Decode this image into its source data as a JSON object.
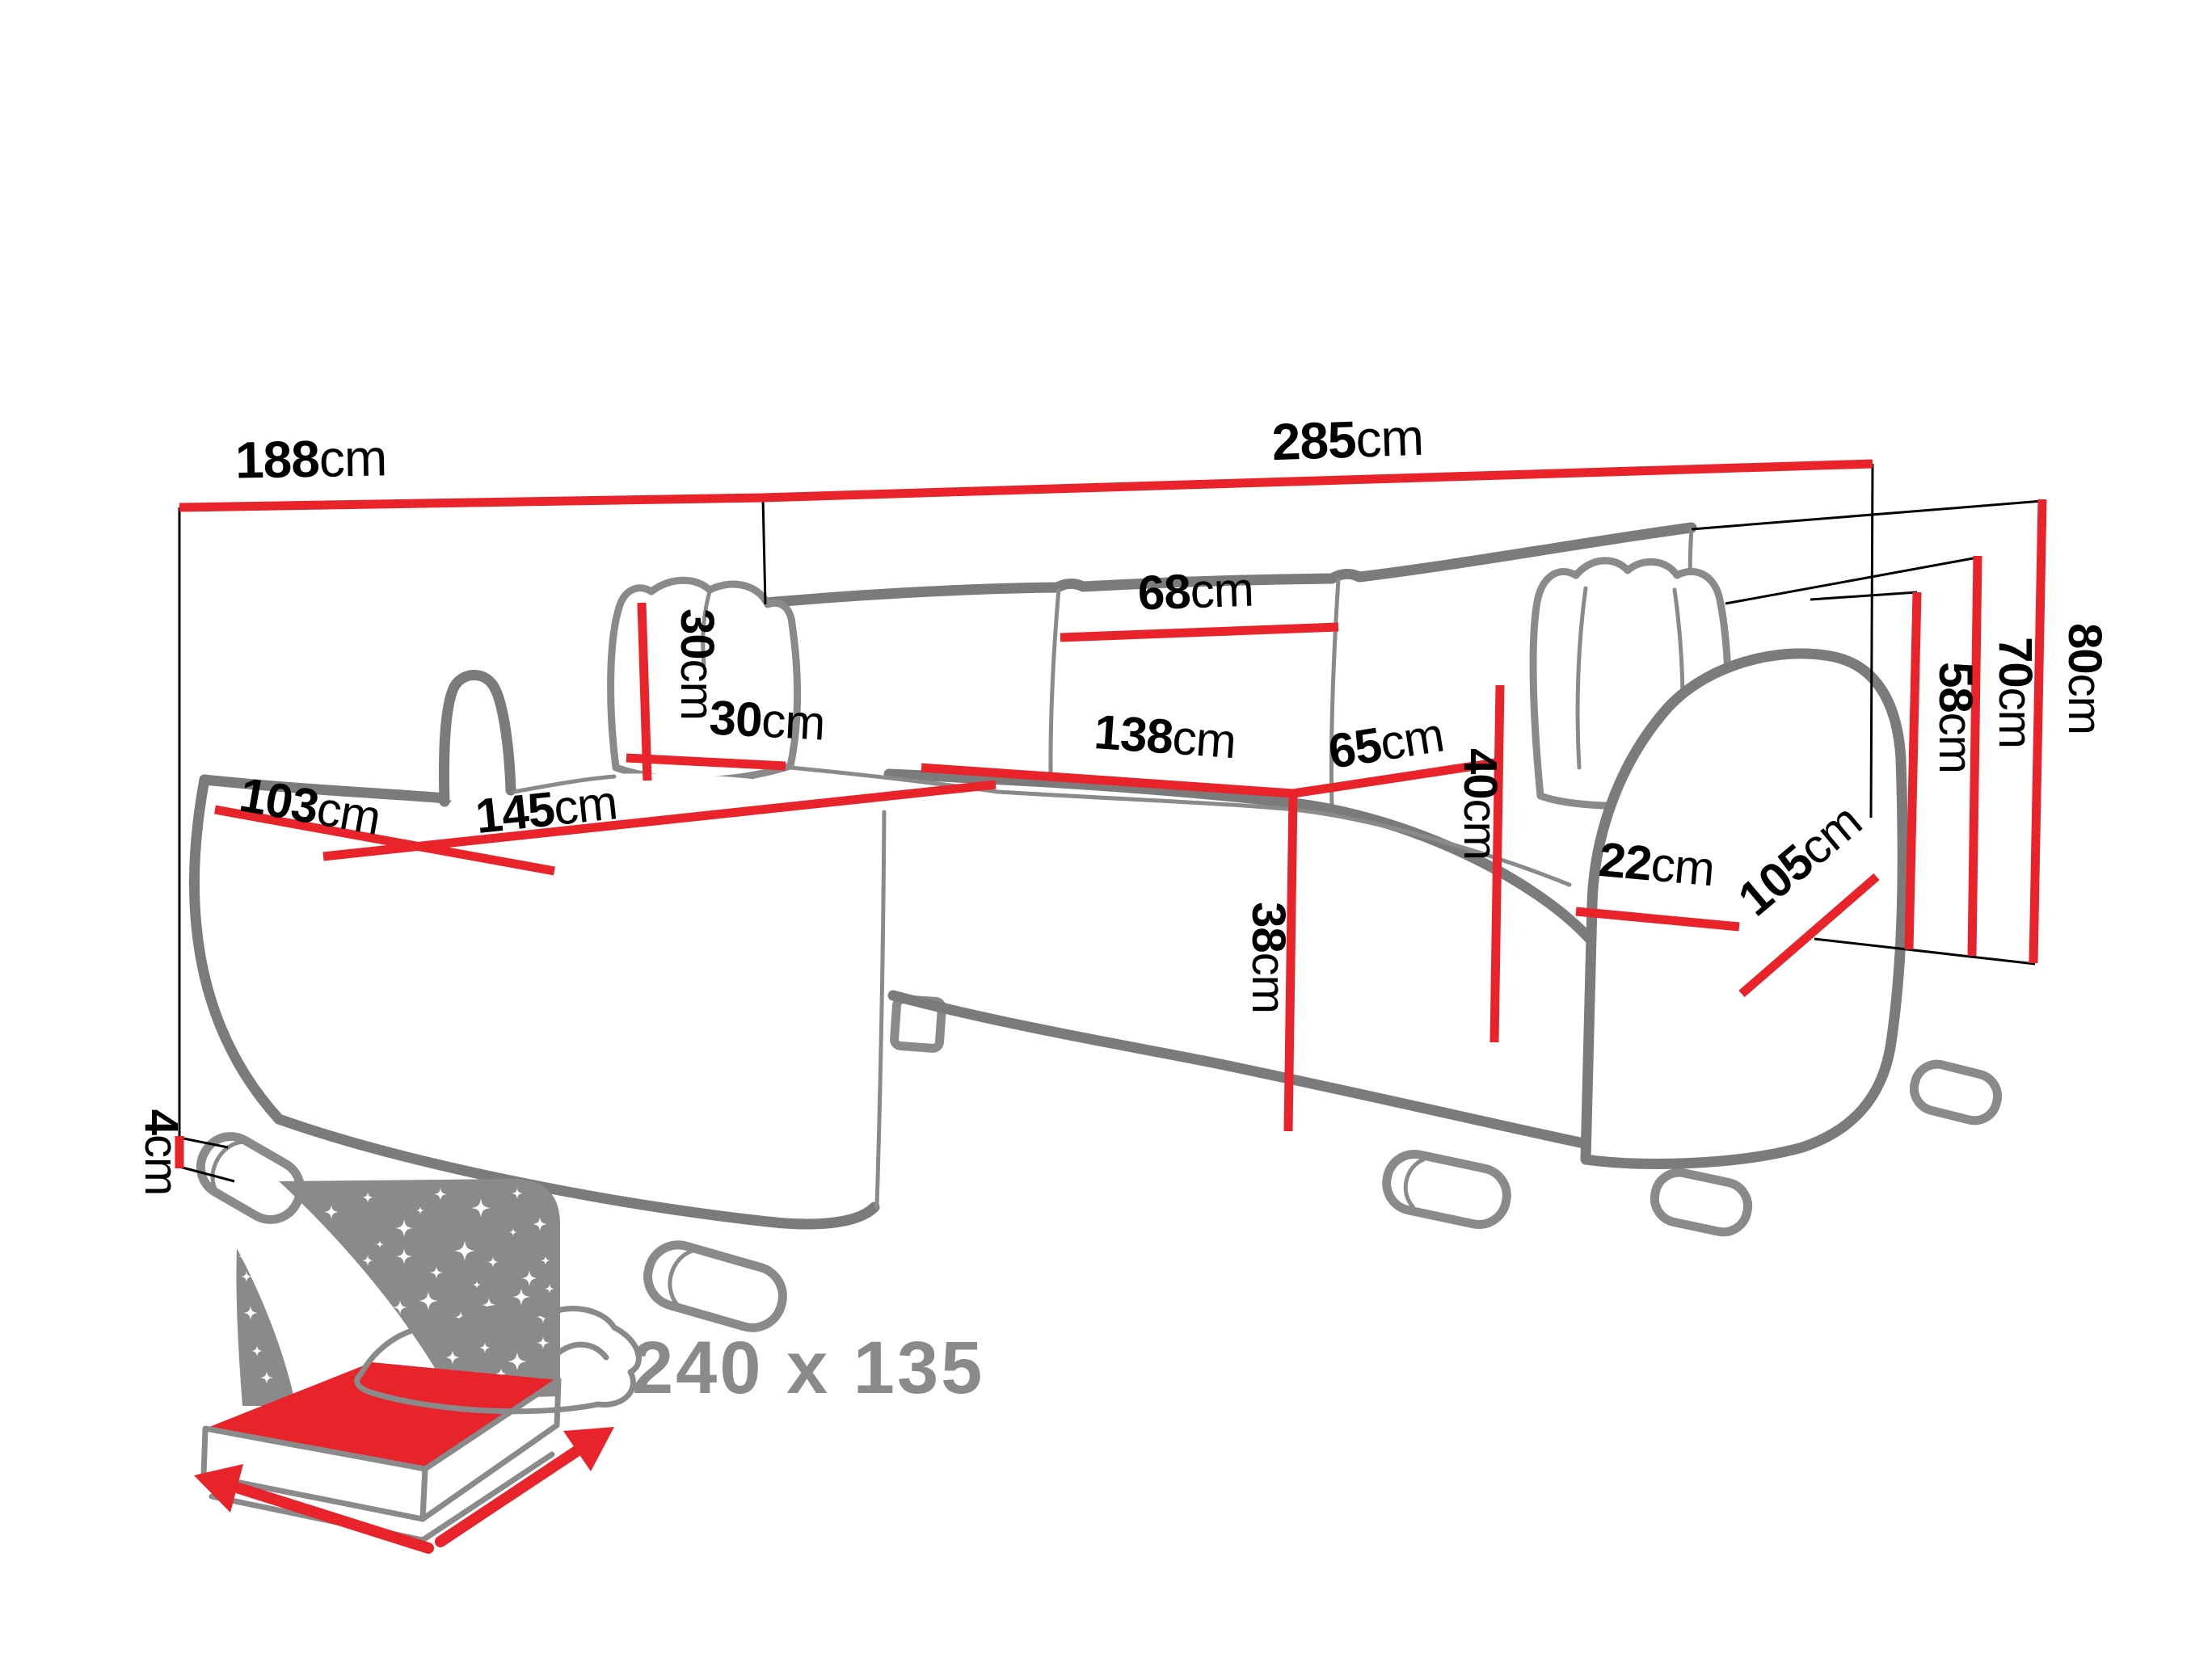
{
  "diagram": {
    "title": "corner-sofa-dimension-diagram",
    "colors": {
      "dimension_red": "#e8232a",
      "sofa_outline_gray": "#7b7b7b",
      "icon_gray": "#8a8a8a",
      "text_black": "#000000"
    },
    "measurements": {
      "chaise_total_width": {
        "value": "188",
        "unit": "cm"
      },
      "total_length": {
        "value": "285",
        "unit": "cm"
      },
      "pillow_height": {
        "value": "30",
        "unit": "cm"
      },
      "pillow_width": {
        "value": "30",
        "unit": "cm"
      },
      "chaise_depth": {
        "value": "103",
        "unit": "cm"
      },
      "chaise_length": {
        "value": "145",
        "unit": "cm"
      },
      "back_cushion_width": {
        "value": "68",
        "unit": "cm"
      },
      "backrest_height": {
        "value": "40",
        "unit": "cm"
      },
      "seat_width": {
        "value": "138",
        "unit": "cm"
      },
      "seat_depth": {
        "value": "65",
        "unit": "cm"
      },
      "seat_height": {
        "value": "38",
        "unit": "cm"
      },
      "leg_height": {
        "value": "4",
        "unit": "cm"
      },
      "armrest_width": {
        "value": "22",
        "unit": "cm"
      },
      "side_depth": {
        "value": "105",
        "unit": "cm"
      },
      "armrest_height": {
        "value": "58",
        "unit": "cm"
      },
      "back_pillow_height": {
        "value": "70",
        "unit": "cm"
      },
      "total_height": {
        "value": "80",
        "unit": "cm"
      }
    },
    "sleeping_area": {
      "size_label": "240 x 135"
    }
  }
}
